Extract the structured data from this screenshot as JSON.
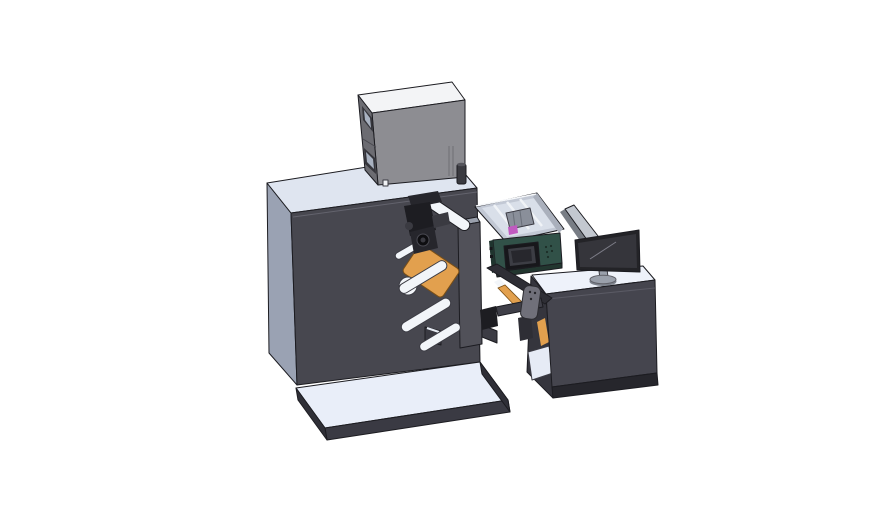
{
  "scene": {
    "background": "#ffffff"
  },
  "colors": {
    "outline": "#1c1c21",
    "cabinet_front": "#47474f",
    "cabinet_side": "#9aa2b3",
    "cabinet_top": "#dfe5f0",
    "box_top": "#f3f4f6",
    "box_front": "#8d8d92",
    "box_side": "#6c6c72",
    "vent_frame": "#35353b",
    "vent_glass": "#a8b1c0",
    "detail_square": "#f0f2f5",
    "stack_light_body": "#3a3a40",
    "stack_light_top": "#55555c",
    "platform_top": "#e9eef9",
    "platform_front": "#3a3a43",
    "platform_side": "#2f2f37",
    "plate_gray": "#515159",
    "plate_top": "#9aa0ac",
    "foot_gray": "#3a3a42",
    "roller_white": "#f2f5f9",
    "roller_core": "#c7ccd4",
    "web_orange": "#e2a04e",
    "web_orange_edge": "#7a4f16",
    "mech_black": "#1d1d22",
    "mech_black2": "#26262c",
    "mech_gray": "#3a3a41",
    "knob_dark": "#0e0e11",
    "tray_wall": "#c2c8d4",
    "tray_wall_right": "#aab0bc",
    "tray_inner": "#d9dfe9",
    "tray_rib": "#f0f3f7",
    "cartridge_gray": "#8a8f9a",
    "cartridge_magenta": "#c05ac0",
    "printer_teal": "#315148",
    "printer_teal_dark": "#1f342e",
    "printer_base": "#22362f",
    "screen_bezel": "#17171b",
    "screen_face": "#3c3d44",
    "screen_inner": "#27272d",
    "desk_top": "#eef2fa",
    "desk_front": "#45454e",
    "desk_base": "#26262c",
    "desk_inner": "#35353d",
    "shelf_white": "#e6ebf5",
    "panel_light": "#c3c8d0",
    "panel_edge": "#787d85",
    "monitor_bezel": "#232327",
    "monitor_screen": "#35353b",
    "monitor_highlight": "#7d7d88",
    "monitor_stand": "#9aa0ab",
    "pendant_gray": "#70707a",
    "pendant_dot": "#26262b",
    "bracket_dark": "#2e2e35",
    "bracket_bar": "#3f3f48",
    "step_gray": "#3c3c44",
    "white_guide": "#f2f5f9"
  },
  "parts": {
    "main_cabinet": "machine body cabinet",
    "control_box": "top electronics enclosure",
    "stack_light": "small post on cabinet top",
    "unwind_station": "roller plate with web rollers",
    "print_mechanism": "black print-head mechanism",
    "media_web": "orange label web and rolls",
    "ink_tray": "open tray with cartridge",
    "printer_unit": "teal printer module with touchscreen",
    "machine_base": "white base plinth",
    "desk": "operator desk cabinet",
    "divider_panel": "light side panel",
    "monitor": "desktop monitor with stand",
    "pendant": "hand-held control pendant"
  }
}
